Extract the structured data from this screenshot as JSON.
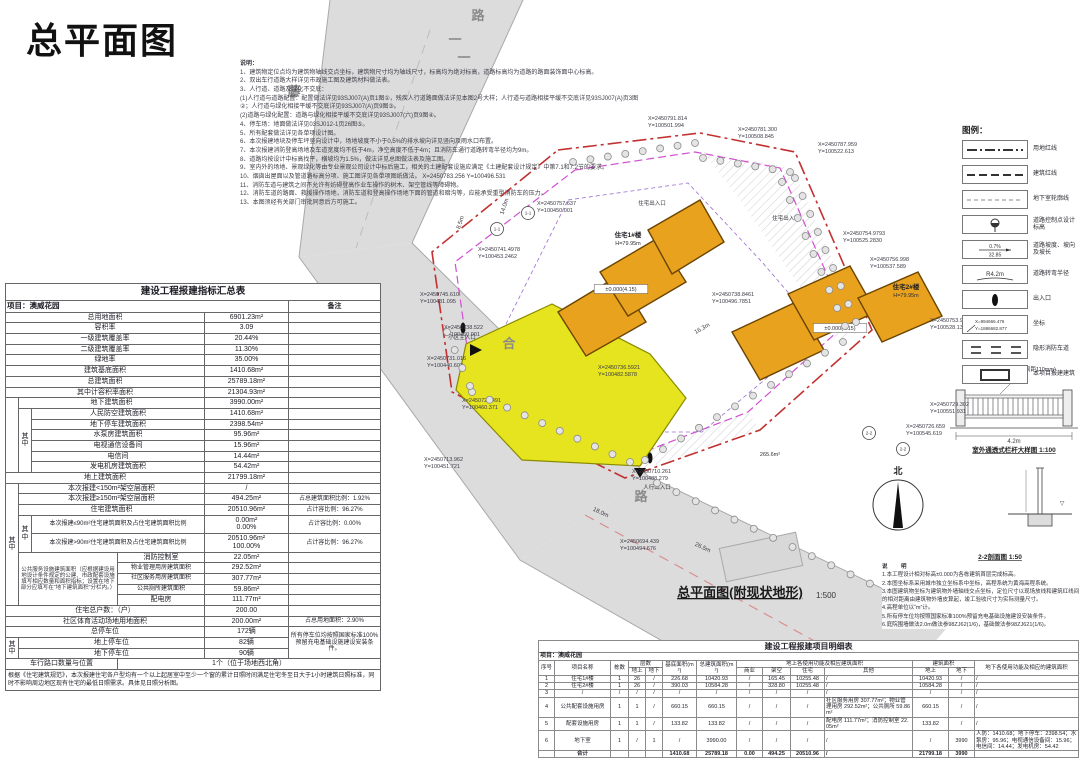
{
  "page": {
    "title": "总平面图"
  },
  "colors": {
    "land_line_red": "#c23030",
    "building_line_magenta": "#d24fd2",
    "basement_line_purple": "#9a6ad0",
    "building_orange": "#e8a21e",
    "podium_yellow": "#e6e41f",
    "road_gray": "#dcdcdc"
  },
  "top_notes": {
    "heading": "说明：",
    "lines": [
      "1、建筑物定位点均为建筑物轴线交点坐标，建筑物尺寸均为轴线尺寸，标高均为绝对标高，道路标高均为道路的路面装饰面中心标高。",
      "2、双出车行道路大样详见市政施工图及建筑材料做法表。",
      "3、人行道、道路及绿化不交底：",
      "(1)人行道与道路配置：配置做法详见93SJ007(A)页1图①，残疾人行道路面做法详见本图2号大样；人行道与道路相接平缓不交底详见93SJ007(A)页3图②；人行道与绿化相接平缓不交底详见93SJ007(A)页9图③。",
      "(2)道路与绿化配置：道路与绿化相接平缓不交底详见93SJ007(六)页9图④。",
      "4、停车场：地面做法详见03SJ012-1页26图⑤。",
      "5、所有配套做法详见各单项设计图。",
      "6、本次报建地块及停车坪竖向设计中，场地坡度不小于0.5%的排水坡向详见竖向及雨水口布置。",
      "7、本次报建消防登高场地及车道宽度均不低于4m，净空高度不低于4m；且消防车通行道路转弯半径均为9m。",
      "8、道路均按设计中标高找平，横坡均为1.5%，做法详见总图做法表及施工图。",
      "9、室内外的场地、景观绿化等由专业景观公司设计中标后施工，相关的土建配套设施应满足《土建配套设计规定》中第7.1和7.2节的要求。",
      "10、烟囱出屋面以及管道路标高分项、施工图详见各单项图纸做法。 X=2450783.256  Y=100496.531",
      "11、消防车道与建筑之间不允许有妨碍登高作业车操作的树木、架空管线等障碍物。",
      "12、消防车道的路面、救援操作场地，消防车道和登高操作场地下面的管道和暗沟等，应能承受重型消防车的压力。",
      "13、本图须经有关部门审批同意后方可施工。"
    ]
  },
  "summary_table": {
    "rows": [
      [
        [
          "建设工程报建指标汇总表",
          6,
          1,
          "tt"
        ]
      ],
      [
        [
          "项目：澳威花园",
          5,
          1,
          "proj"
        ],
        [
          "备注",
          1,
          1,
          "c hb"
        ]
      ],
      [
        [
          "总用地面积",
          4,
          1,
          "c"
        ],
        [
          "6901.23m²",
          1,
          1,
          "c"
        ],
        [
          "",
          1,
          1,
          ""
        ]
      ],
      [
        [
          "容积率",
          4,
          1,
          "c"
        ],
        [
          "3.09",
          1,
          1,
          "c"
        ],
        [
          "",
          1,
          1,
          ""
        ]
      ],
      [
        [
          "一级建筑覆盖率",
          4,
          1,
          "c"
        ],
        [
          "20.44%",
          1,
          1,
          "c"
        ],
        [
          "",
          1,
          1,
          ""
        ]
      ],
      [
        [
          "二级建筑覆盖率",
          4,
          1,
          "c"
        ],
        [
          "11.30%",
          1,
          1,
          "c"
        ],
        [
          "",
          1,
          1,
          ""
        ]
      ],
      [
        [
          "绿地率",
          4,
          1,
          "c"
        ],
        [
          "35.00%",
          1,
          1,
          "c"
        ],
        [
          "",
          1,
          1,
          ""
        ]
      ],
      [
        [
          "建筑基底面积",
          4,
          1,
          "c"
        ],
        [
          "1410.68m²",
          1,
          1,
          "c"
        ],
        [
          "",
          1,
          1,
          ""
        ]
      ],
      [
        [
          "总建筑面积",
          4,
          1,
          "c"
        ],
        [
          "25789.18m²",
          1,
          1,
          "c"
        ],
        [
          "",
          1,
          1,
          ""
        ]
      ],
      [
        [
          "其中计容积率面积",
          4,
          1,
          "c"
        ],
        [
          "21304.93m²",
          1,
          1,
          "c"
        ],
        [
          "",
          1,
          1,
          ""
        ]
      ],
      [
        [
          "",
          1,
          7,
          ""
        ],
        [
          "地下建筑面积",
          3,
          1,
          "c"
        ],
        [
          "3990.00m²",
          1,
          1,
          "c"
        ],
        [
          "",
          1,
          1,
          ""
        ]
      ],
      [
        [
          "其中",
          1,
          6,
          "v"
        ],
        [
          "人民防空建筑面积",
          2,
          1,
          "c"
        ],
        [
          "1410.68m²",
          1,
          1,
          "c"
        ],
        [
          "",
          1,
          1,
          ""
        ]
      ],
      [
        [
          "地下停车建筑面积",
          2,
          1,
          "c"
        ],
        [
          "2398.54m²",
          1,
          1,
          "c"
        ],
        [
          "",
          1,
          1,
          ""
        ]
      ],
      [
        [
          "水泵房建筑面积",
          2,
          1,
          "c"
        ],
        [
          "95.96m²",
          1,
          1,
          "c"
        ],
        [
          "",
          1,
          1,
          ""
        ]
      ],
      [
        [
          "电视通信设备间",
          2,
          1,
          "c"
        ],
        [
          "15.96m²",
          1,
          1,
          "c"
        ],
        [
          "",
          1,
          1,
          ""
        ]
      ],
      [
        [
          "电信间",
          2,
          1,
          "c"
        ],
        [
          "14.44m²",
          1,
          1,
          "c"
        ],
        [
          "",
          1,
          1,
          ""
        ]
      ],
      [
        [
          "发电机房建筑面积",
          2,
          1,
          "c"
        ],
        [
          "54.42m²",
          1,
          1,
          "c"
        ],
        [
          "",
          1,
          1,
          ""
        ]
      ],
      [
        [
          "地上建筑面积",
          4,
          1,
          "c"
        ],
        [
          "21799.18m²",
          1,
          1,
          "c"
        ],
        [
          "",
          1,
          1,
          ""
        ]
      ],
      [
        [
          "其中",
          1,
          10,
          "v"
        ],
        [
          "本次报建<150m²架空层面积",
          3,
          1,
          "c"
        ],
        [
          "/",
          1,
          1,
          "c"
        ],
        [
          "",
          1,
          1,
          ""
        ]
      ],
      [
        [
          "本次报建≥150m²架空层面积",
          3,
          1,
          "c"
        ],
        [
          "494.25m²",
          1,
          1,
          "c"
        ],
        [
          "占总建筑面积比例：1.92%",
          1,
          1,
          "r"
        ]
      ],
      [
        [
          "住宅建筑面积",
          3,
          1,
          "c"
        ],
        [
          "20510.96m²",
          1,
          1,
          "c"
        ],
        [
          "占计容比例：96.27%",
          1,
          1,
          "r"
        ]
      ],
      [
        [
          "其中",
          1,
          2,
          "v"
        ],
        [
          "本次报建≤90m²住宅建筑面积及占住宅建筑面积比例",
          2,
          1,
          "c sm"
        ],
        [
          "0.00m²\n0.00%",
          1,
          1,
          "c two"
        ],
        [
          "占计容比例：0.00%",
          1,
          1,
          "r"
        ]
      ],
      [
        [
          "本次报建>90m²住宅建筑面积及占住宅建筑面积比例",
          2,
          1,
          "c sm"
        ],
        [
          "20510.96m²\n100.00%",
          1,
          1,
          "c two"
        ],
        [
          "占计容比例：96.27%",
          1,
          1,
          "r"
        ]
      ],
      [
        [
          "公共服务设施建筑面积（应根据建设用地设计条件规定的公建、市政配套设施填写相应数量和面积指标；设置在地下部分应填写在“地下建筑面积”分栏内。）",
          2,
          5,
          "note"
        ],
        [
          "消防控制室",
          1,
          1,
          "c"
        ],
        [
          "22.05m²",
          1,
          1,
          "c"
        ],
        [
          "",
          1,
          1,
          ""
        ]
      ],
      [
        [
          "物业管理用房建筑面积",
          1,
          1,
          "c sm"
        ],
        [
          "292.52m²",
          1,
          1,
          "c"
        ],
        [
          "",
          1,
          1,
          ""
        ]
      ],
      [
        [
          "社区服务用房建筑面积",
          1,
          1,
          "c sm"
        ],
        [
          "307.77m²",
          1,
          1,
          "c"
        ],
        [
          "",
          1,
          1,
          ""
        ]
      ],
      [
        [
          "公共厕所建筑面积",
          1,
          1,
          "c sm"
        ],
        [
          "59.86m²",
          1,
          1,
          "c"
        ],
        [
          "",
          1,
          1,
          ""
        ]
      ],
      [
        [
          "配电房",
          1,
          1,
          "c"
        ],
        [
          "111.77m²",
          1,
          1,
          "c"
        ],
        [
          "",
          1,
          1,
          ""
        ]
      ],
      [
        [
          "住宅总户数：（户）",
          4,
          1,
          "c"
        ],
        [
          "200.00",
          1,
          1,
          "c"
        ],
        [
          "",
          1,
          1,
          ""
        ]
      ],
      [
        [
          "社区体育活动场地用地面积",
          4,
          1,
          "c"
        ],
        [
          "200.00m²",
          1,
          1,
          "c"
        ],
        [
          "占总用地面积：2.90%",
          1,
          1,
          "r"
        ]
      ],
      [
        [
          "总停车位",
          4,
          1,
          "c"
        ],
        [
          "172辆",
          1,
          1,
          "c"
        ],
        [
          "所有停车位均按照国家标准100%预留充电基础设施建设安装条件。",
          1,
          3,
          "r sm"
        ]
      ],
      [
        [
          "其中",
          1,
          2,
          "v"
        ],
        [
          "地上停车位",
          3,
          1,
          "c"
        ],
        [
          "82辆",
          1,
          1,
          "c"
        ]
      ],
      [
        [
          "地下停车位",
          3,
          1,
          "c"
        ],
        [
          "90辆",
          1,
          1,
          "c"
        ]
      ],
      [
        [
          "车行路口数量与位置",
          3,
          1,
          "c"
        ],
        [
          "1个（位于场地西北角）",
          3,
          1,
          "c"
        ]
      ],
      [
        [
          "根据《住宅建筑规范》，本次报建住宅各户型均有一个以上起居室中至少一个窗的累计日照时间满足住宅冬至日大于1小时建筑日照标准，同时不影响周边地区现有住宅的最低日照需求。具体见日照分析图。",
          6,
          1,
          "ft"
        ]
      ]
    ]
  },
  "legend": {
    "title": "图例：",
    "items": [
      {
        "type": "dashdot",
        "label": "用地红线"
      },
      {
        "type": "dash",
        "label": "建筑红线"
      },
      {
        "type": "finedash",
        "label": "地下室轮廓线"
      },
      {
        "type": "spot",
        "label": "道路控制点设计标高"
      },
      {
        "type": "slope",
        "a": "0.7%",
        "b": "32.85",
        "label": "道路坡度、坡向及坡长"
      },
      {
        "type": "radius",
        "a": "R4.2m",
        "label": "道路转弯半径"
      },
      {
        "type": "entry",
        "label": "出入口"
      },
      {
        "type": "coord",
        "a": "X=994666.476",
        "b": "Y=1886682.877",
        "label": "坐标"
      },
      {
        "type": "fire",
        "label": "隐形消防车道"
      },
      {
        "type": "bld",
        "label": "本项目报建建筑"
      }
    ]
  },
  "right_notes": {
    "heading": "说 明",
    "lines": [
      "1.本工程设计相对标高±0.000为各栋建筑首层完成标高。",
      "2.本图坐标系采用城市独立坐标系中坐标，高程系统为黄海高程系统。",
      "3.本图建筑物坐标为建筑物外墙轴线交点坐标，定位尺寸以现场放线和建筑红线间的相对距离由建筑物外墙皮算起，竣工验收尺寸为实际测量尺寸。",
      "4.高程单位以“m”计。",
      "5.所有停车位均按照国家标准100%预留充电基础设施建设安装条件。",
      "6.庭院围墙做法2.0m做法参98ZJ62(1/6)，基础做法参98ZJ621(1/6)。"
    ]
  },
  "plan": {
    "caption": "总平面图(附现状地形)",
    "caption_scale": "1:500",
    "north_label": "北",
    "coords": [
      {
        "x": 648,
        "y": 120,
        "a": "X=2450791.814",
        "b": "Y=100501.994"
      },
      {
        "x": 738,
        "y": 131,
        "a": "X=2450781.300",
        "b": "Y=100508.845"
      },
      {
        "x": 818,
        "y": 146,
        "a": "X=2450787.959",
        "b": "Y=100522.613"
      },
      {
        "x": 537,
        "y": 205,
        "a": "X=2450757.637",
        "b": "Y=100450.001"
      },
      {
        "x": 843,
        "y": 235,
        "a": "X=2450754.9793",
        "b": "Y=100525.2830"
      },
      {
        "x": 870,
        "y": 261,
        "a": "X=2450756.998",
        "b": "Y=100537.589"
      },
      {
        "x": 478,
        "y": 251,
        "a": "X=2450741.4978",
        "b": "Y=100453.2462"
      },
      {
        "x": 420,
        "y": 296,
        "a": "X=2450745.610",
        "b": "Y=100431.095"
      },
      {
        "x": 444,
        "y": 329,
        "a": "X=2450738.522",
        "b": "Y=100460.001"
      },
      {
        "x": 427,
        "y": 360,
        "a": "X=2450731.016",
        "b": "Y=100440.603"
      },
      {
        "x": 462,
        "y": 402,
        "a": "X=2450722.491",
        "b": "Y=100460.371"
      },
      {
        "x": 712,
        "y": 296,
        "a": "X=2450738.8461",
        "b": "Y=100496.7851"
      },
      {
        "x": 598,
        "y": 369,
        "a": "X=2450736.5921",
        "b": "Y=100482.5878"
      },
      {
        "x": 930,
        "y": 322,
        "a": "X=2450753.941",
        "b": "Y=100528.130"
      },
      {
        "x": 930,
        "y": 406,
        "a": "X=2450729.302",
        "b": "Y=100551.931"
      },
      {
        "x": 906,
        "y": 428,
        "a": "X=2450726.659",
        "b": "Y=100545.619"
      },
      {
        "x": 424,
        "y": 461,
        "a": "X=2450713.962",
        "b": "Y=100451.721"
      },
      {
        "x": 632,
        "y": 473,
        "a": "X=2450710.261",
        "b": "Y=100488.279"
      },
      {
        "x": 620,
        "y": 543,
        "a": "X=2450694.439",
        "b": "Y=100494.676"
      }
    ],
    "labels": [
      {
        "x": 628,
        "y": 237,
        "t": "住宅1#楼",
        "c": "plb"
      },
      {
        "x": 628,
        "y": 245,
        "t": "H=79.95m",
        "c": "pl"
      },
      {
        "x": 906,
        "y": 289,
        "t": "住宅2#楼",
        "c": "plb"
      },
      {
        "x": 906,
        "y": 297,
        "t": "H=79.95m",
        "c": "pl"
      },
      {
        "x": 621,
        "y": 291,
        "t": "±0.000(4.15)",
        "c": "pl",
        "box": 1
      },
      {
        "x": 840,
        "y": 330,
        "t": "±0.000(4.15)",
        "c": "pl",
        "box": 1
      },
      {
        "x": 703,
        "y": 330,
        "t": "16.3m",
        "c": "dim",
        "r": -30
      },
      {
        "x": 652,
        "y": 205,
        "t": "住宅出入口",
        "c": "pl"
      },
      {
        "x": 786,
        "y": 220,
        "t": "住宅出入口",
        "c": "pl"
      },
      {
        "x": 462,
        "y": 339,
        "t": "小区主入口",
        "c": "pl"
      },
      {
        "x": 657,
        "y": 489,
        "t": "人行出入口",
        "c": "pl"
      },
      {
        "x": 770,
        "y": 456,
        "t": "265.6m²",
        "c": "pl"
      },
      {
        "x": 478,
        "y": 20,
        "t": "路",
        "c": "rd"
      },
      {
        "x": 455,
        "y": 44,
        "t": "一",
        "c": "rd"
      },
      {
        "x": 464,
        "y": 62,
        "t": "一",
        "c": "rd"
      },
      {
        "x": 294,
        "y": 96,
        "t": "藤",
        "c": "rd"
      },
      {
        "x": 509,
        "y": 348,
        "t": "合",
        "c": "rd"
      },
      {
        "x": 641,
        "y": 501,
        "t": "路",
        "c": "rd"
      },
      {
        "x": 740,
        "y": 597,
        "t": "总平面图(附现状地形)",
        "c": "cap"
      },
      {
        "x": 826,
        "y": 598,
        "t": "1:500",
        "c": "caps"
      },
      {
        "x": 898,
        "y": 474,
        "t": "北",
        "c": "north"
      },
      {
        "x": 462,
        "y": 223,
        "t": "8.5m",
        "c": "dim",
        "r": -72
      },
      {
        "x": 506,
        "y": 207,
        "t": "14.0m",
        "c": "dim",
        "r": -72
      },
      {
        "x": 600,
        "y": 514,
        "t": "18.0m",
        "c": "dim",
        "r": 25
      },
      {
        "x": 702,
        "y": 549,
        "t": "26.5m",
        "c": "dim",
        "r": 25
      },
      {
        "x": 1014,
        "y": 452,
        "t": "室外通透式栏杆大样图 1:100",
        "c": "capd"
      },
      {
        "x": 1000,
        "y": 559,
        "t": "2-2剖面图 1:50",
        "c": "capd"
      },
      {
        "x": 1014,
        "y": 443,
        "t": "4.2m",
        "c": "dim"
      },
      {
        "x": 1062,
        "y": 505,
        "t": "▽",
        "c": "dim"
      },
      {
        "x": 1012,
        "y": 378,
        "t": "②",
        "c": "dim"
      },
      {
        "x": 1034,
        "y": 371,
        "t": "(竖杆间距110mm)",
        "c": "pl"
      }
    ],
    "section_markers": [
      {
        "x": 497,
        "y": 229,
        "t": "1-1"
      },
      {
        "x": 528,
        "y": 213,
        "t": "1-1"
      },
      {
        "x": 869,
        "y": 433,
        "t": "2-2"
      },
      {
        "x": 903,
        "y": 449,
        "t": "2-2"
      }
    ]
  },
  "detail_table": {
    "title": "建设工程报建项目明细表",
    "project": "项目：澳威花园",
    "h1": [
      "序号",
      "项目名称",
      "栋数",
      "层数",
      "基底面积(m²)",
      "总建筑面积(m²)",
      "地上各使用功能及相应建筑面积",
      "建筑面积",
      "地下各使用功能及相应的建筑面积"
    ],
    "h2": [
      "地上",
      "地下",
      "商业",
      "架空",
      "住宅",
      "其他",
      "地上",
      "地下"
    ],
    "rows": [
      [
        "1",
        "住宅1#楼",
        "1",
        "26",
        "/",
        "226.68",
        "10420.93",
        "/",
        "165.45",
        "10255.48",
        "/",
        "10420.93",
        "/",
        "/"
      ],
      [
        "2",
        "住宅2#楼",
        "1",
        "26",
        "/",
        "390.03",
        "10584.28",
        "/",
        "328.80",
        "10255.48",
        "/",
        "10584.28",
        "/",
        "/"
      ],
      [
        "3",
        "/",
        "/",
        "/",
        "/",
        "/",
        "/",
        "/",
        "/",
        "/",
        "/",
        "/",
        "/",
        "/"
      ],
      [
        "4",
        "公共配套设施用房",
        "1",
        "1",
        "/",
        "660.15",
        "660.15",
        "/",
        "/",
        "/",
        "社区服务用房 307.77m²；物业管理用房 292.52m²；公共厕所 59.86m²",
        "660.15",
        "/",
        "/"
      ],
      [
        "5",
        "配套设施用房",
        "1",
        "1",
        "/",
        "133.82",
        "133.82",
        "/",
        "/",
        "/",
        "配电房 111.77m²；消防控制室 22.05m²",
        "133.82",
        "/",
        "/"
      ],
      [
        "6",
        "地下室",
        "1",
        "/",
        "1",
        "/",
        "3990.00",
        "/",
        "/",
        "/",
        "/",
        "/",
        "3990",
        "人防：1410.68；地下停车：2398.54；水泵房：95.96；电视通信设备间：15.96；电信间：14.44；发电机房：54.42"
      ],
      [
        "",
        "合计",
        "",
        "",
        "",
        "1410.68",
        "25789.18",
        "0.00",
        "494.25",
        "20510.96",
        "/",
        "21799.18",
        "3990",
        ""
      ]
    ]
  }
}
